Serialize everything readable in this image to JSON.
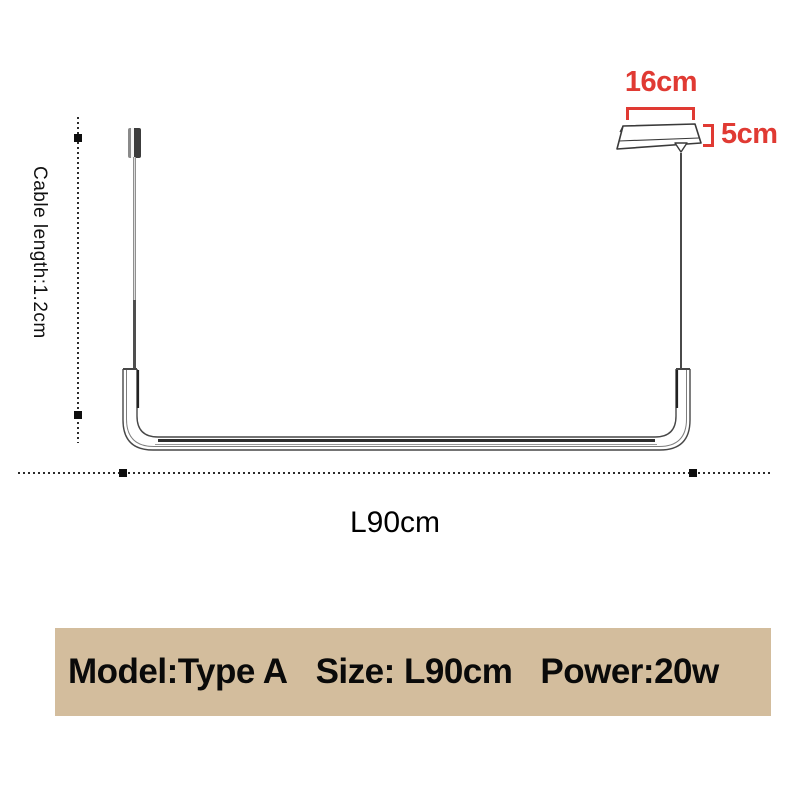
{
  "colors": {
    "dimension_red": "#e03a33",
    "line_black": "#2b2b2b",
    "banner_background": "#d3bd9d",
    "banner_text": "#0a0a0a"
  },
  "dimensions": {
    "canopy_width_label": "16cm",
    "canopy_height_label": "5cm",
    "cable_length_label": "Cable length:1.2cm",
    "lamp_length_label": "L90cm"
  },
  "banner": {
    "model": "Model:Type A",
    "size": "Size: L90cm",
    "power": "Power:20w"
  }
}
